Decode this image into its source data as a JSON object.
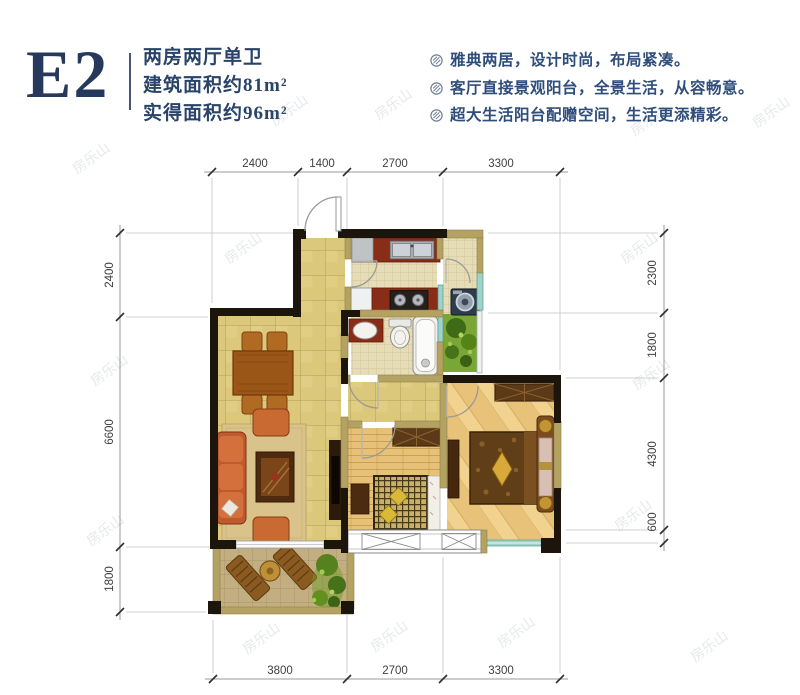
{
  "header": {
    "unit_code": "E2",
    "layout_line": "两房两厅单卫",
    "area_line1": "建筑面积约81m²",
    "area_line2": "实得面积约96m²"
  },
  "features": {
    "items": [
      "雅典两居，设计时尚，布局紧凑。",
      "客厅直接景观阳台，全景生活，从容畅意。",
      "超大生活阳台配赠空间，生活更添精彩。"
    ]
  },
  "floorplan": {
    "dimensions": {
      "top": [
        "2400",
        "1400",
        "2700",
        "3300"
      ],
      "left": [
        "2400",
        "6600",
        "1800"
      ],
      "right": [
        "2300",
        "1800",
        "4300",
        "600"
      ],
      "bottom": [
        "3800",
        "2700",
        "3300"
      ]
    }
  },
  "watermark": {
    "text": "房乐山"
  },
  "colors": {
    "title_navy": "#26395c",
    "feature_navy": "#2e4d7a",
    "tile_floor": "#dcc87b",
    "wood_floor": "#e7c178",
    "counter_red": "#8a2d18",
    "plant_green": "#7aa636",
    "wall_dark": "#1b150c",
    "wall_tan": "#b4a263",
    "window_teal": "#9fd2c8"
  }
}
